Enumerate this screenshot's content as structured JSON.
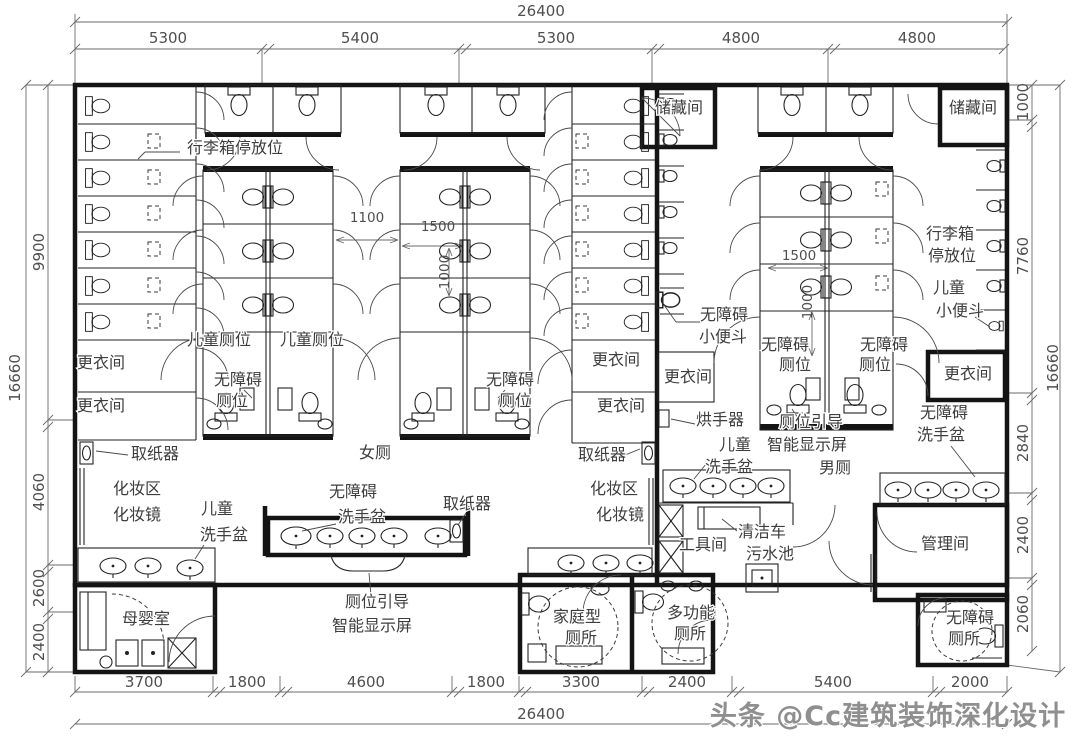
{
  "watermark": "头条 @Cc建筑装饰深化设计",
  "dims": {
    "overall": "26400",
    "top": [
      "5300",
      "5400",
      "5300",
      "4800",
      "4800"
    ],
    "bottom": [
      "3700",
      "1800",
      "4600",
      "1800",
      "3300",
      "2400",
      "5400",
      "2000"
    ],
    "left_overall": "16660",
    "left": [
      "9900",
      "4060",
      "2600",
      "2400"
    ],
    "right_overall": "16660",
    "right": [
      "1000",
      "7760",
      "2840",
      "2400",
      "2060"
    ],
    "interior": {
      "aisle": "1100",
      "stall_depth": "1500",
      "stall_width": "1000"
    }
  },
  "labels": {
    "luggage": "行李箱停放位",
    "luggage_line1": "行李箱",
    "luggage_line2": "停放位",
    "child_stall": "儿童厕位",
    "accessible": "无障碍",
    "stall": "厕位",
    "changing_room": "更衣间",
    "paper_dispenser": "取纸器",
    "makeup_area": "化妆区",
    "makeup_mirror": "化妆镜",
    "child": "儿童",
    "washbasin": "洗手盆",
    "women_toilet": "女厕",
    "men_toilet": "男厕",
    "mother_baby_room": "母婴室",
    "guide_line1": "厕位引导",
    "guide_line2": "智能显示屏",
    "family_toilet_line1": "家庭型",
    "toilet_room": "厕所",
    "multi_function": "多功能",
    "storage_room": "储藏间",
    "urinal": "小便斗",
    "hand_dryer": "烘手器",
    "tool_room": "工具间",
    "cleaning_cart": "清洁车",
    "sewage_sink": "污水池",
    "management_room": "管理间"
  }
}
